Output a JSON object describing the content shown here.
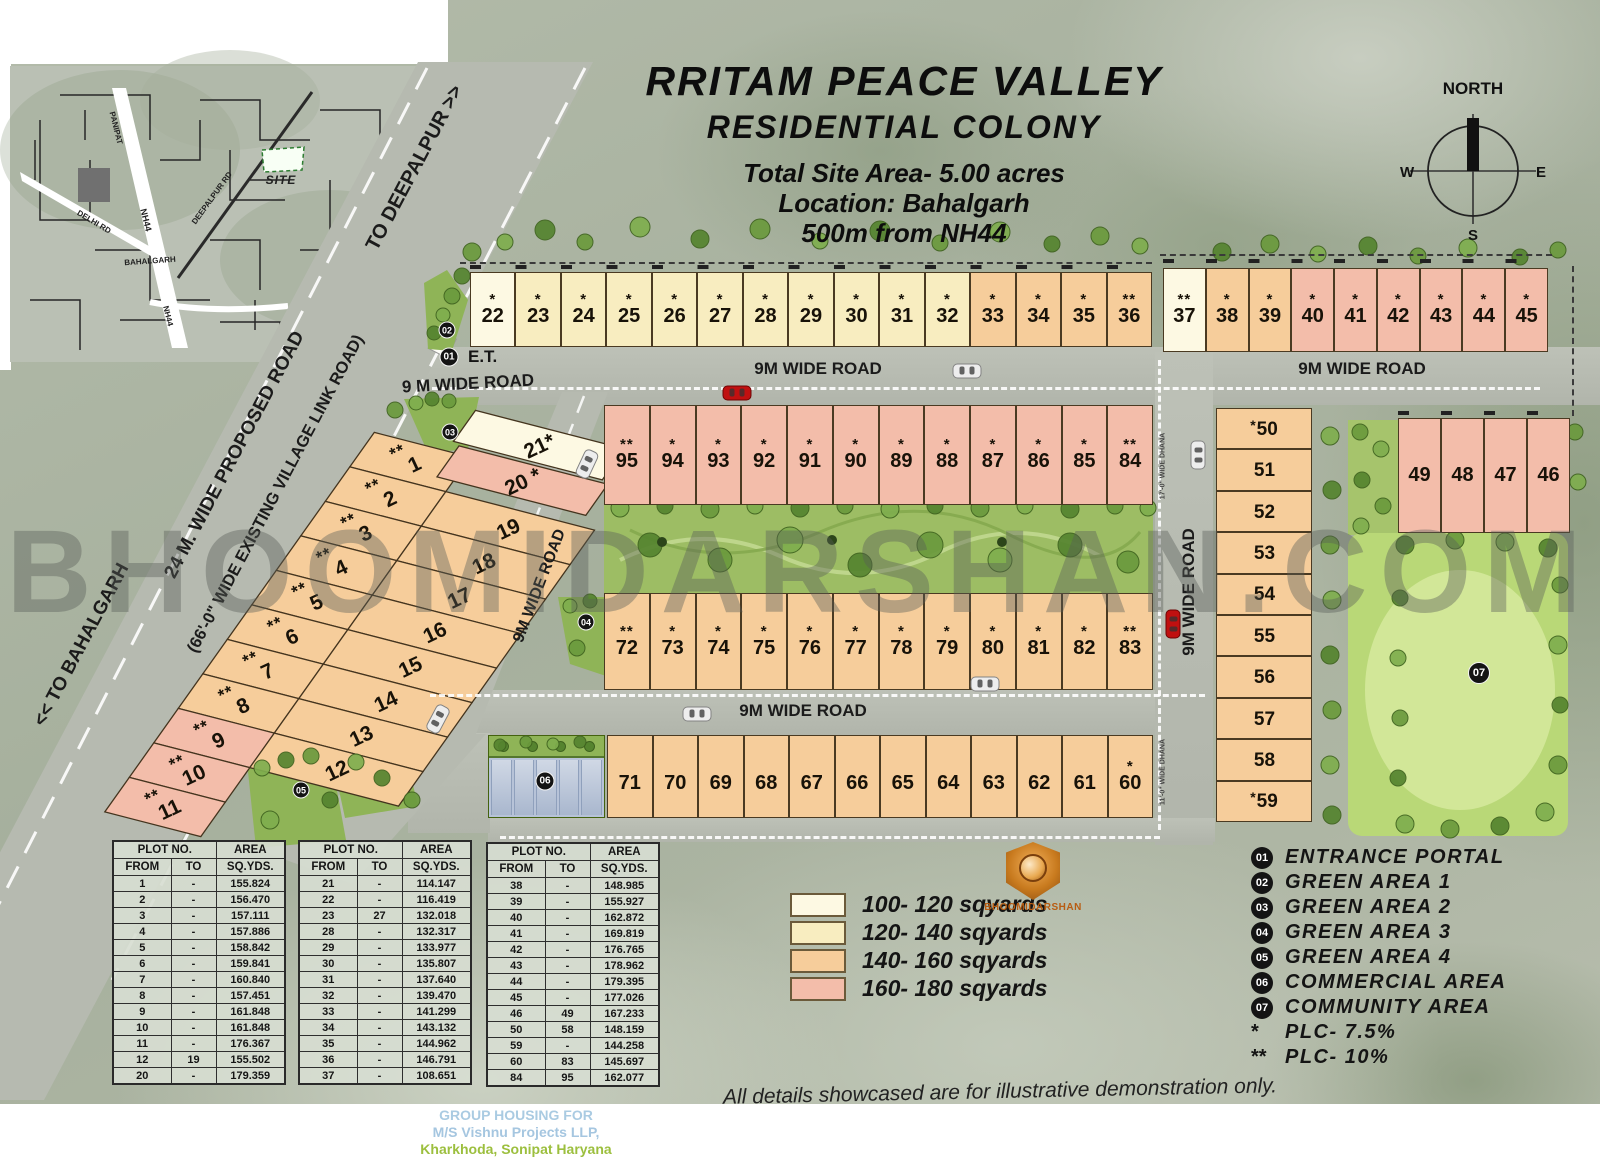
{
  "title": {
    "l1": "RRITAM PEACE VALLEY",
    "l2": "RESIDENTIAL COLONY",
    "l3": "Total Site Area- 5.00 acres",
    "l4": "Location: Bahalgarh",
    "l5": "500m from NH44"
  },
  "compass": {
    "north": "NORTH",
    "west": "W",
    "east": "E",
    "south": "S"
  },
  "inset": {
    "site": "SITE",
    "panipat": "PANIPAT",
    "nh44": "NH44",
    "delhi_rd": "DELHI RD",
    "bahalgarh": "BAHALGARH",
    "deepalpur_rd": "DEEPALPUR RD"
  },
  "road_labels": [
    "TO DEEPALPUR >>",
    "24 M. WIDE PROPOSED ROAD",
    "(66'-0\" WIDE EXISTING VILLAGE LINK ROAD)",
    "<< TO BAHALGARH",
    "9 M WIDE ROAD",
    "9M WIDE ROAD",
    "9M WIDE ROAD",
    "9M WIDE ROAD",
    "9M WIDE ROAD",
    "9M WIDE ROAD",
    "17'-0\" WIDE DHANA",
    "11'-0\" WIDE DHANA"
  ],
  "notes": {
    "et": "E.T.",
    "watermark": "BHOOMIDARSHAN.COM",
    "disclaimer": "All details showcased are for illustrative demonstration only.",
    "footer1": "GROUP HOUSING FOR",
    "footer2": "M/S Vishnu Projects LLP,",
    "footer3": "Kharkhoda, Sonipat Haryana"
  },
  "logo": {
    "name": "BHOOMIDARSHAN"
  },
  "markers": [
    "01",
    "02",
    "03",
    "04",
    "05",
    "06",
    "07"
  ],
  "colors": {
    "cream": "#FDF9E3",
    "yellow": "#F8EDC0",
    "orange": "#F6CD9B",
    "pink": "#F3BDAA"
  },
  "plots": {
    "north_a": [
      {
        "n": "22",
        "s": "*",
        "c": "cream"
      },
      {
        "n": "23",
        "s": "*",
        "c": "yellow"
      },
      {
        "n": "24",
        "s": "*",
        "c": "yellow"
      },
      {
        "n": "25",
        "s": "*",
        "c": "yellow"
      },
      {
        "n": "26",
        "s": "*",
        "c": "yellow"
      },
      {
        "n": "27",
        "s": "*",
        "c": "yellow"
      },
      {
        "n": "28",
        "s": "*",
        "c": "yellow"
      },
      {
        "n": "29",
        "s": "*",
        "c": "yellow"
      },
      {
        "n": "30",
        "s": "*",
        "c": "yellow"
      },
      {
        "n": "31",
        "s": "*",
        "c": "yellow"
      },
      {
        "n": "32",
        "s": "*",
        "c": "yellow"
      },
      {
        "n": "33",
        "s": "*",
        "c": "orange"
      },
      {
        "n": "34",
        "s": "*",
        "c": "orange"
      },
      {
        "n": "35",
        "s": "*",
        "c": "orange"
      },
      {
        "n": "36",
        "s": "**",
        "c": "orange"
      }
    ],
    "north_b": [
      {
        "n": "37",
        "s": "**",
        "c": "cream"
      },
      {
        "n": "38",
        "s": "*",
        "c": "orange"
      },
      {
        "n": "39",
        "s": "*",
        "c": "orange"
      },
      {
        "n": "40",
        "s": "*",
        "c": "pink"
      },
      {
        "n": "41",
        "s": "*",
        "c": "pink"
      },
      {
        "n": "42",
        "s": "*",
        "c": "pink"
      },
      {
        "n": "43",
        "s": "*",
        "c": "pink"
      },
      {
        "n": "44",
        "s": "*",
        "c": "pink"
      },
      {
        "n": "45",
        "s": "*",
        "c": "pink"
      }
    ],
    "mid_pink": [
      {
        "n": "95",
        "s": "**",
        "c": "pink"
      },
      {
        "n": "94",
        "s": "*",
        "c": "pink"
      },
      {
        "n": "93",
        "s": "*",
        "c": "pink"
      },
      {
        "n": "92",
        "s": "*",
        "c": "pink"
      },
      {
        "n": "91",
        "s": "*",
        "c": "pink"
      },
      {
        "n": "90",
        "s": "*",
        "c": "pink"
      },
      {
        "n": "89",
        "s": "*",
        "c": "pink"
      },
      {
        "n": "88",
        "s": "*",
        "c": "pink"
      },
      {
        "n": "87",
        "s": "*",
        "c": "pink"
      },
      {
        "n": "86",
        "s": "*",
        "c": "pink"
      },
      {
        "n": "85",
        "s": "*",
        "c": "pink"
      },
      {
        "n": "84",
        "s": "**",
        "c": "pink"
      }
    ],
    "mid_orange": [
      {
        "n": "72",
        "s": "**",
        "c": "orange"
      },
      {
        "n": "73",
        "s": "*",
        "c": "orange"
      },
      {
        "n": "74",
        "s": "*",
        "c": "orange"
      },
      {
        "n": "75",
        "s": "*",
        "c": "orange"
      },
      {
        "n": "76",
        "s": "*",
        "c": "orange"
      },
      {
        "n": "77",
        "s": "*",
        "c": "orange"
      },
      {
        "n": "78",
        "s": "*",
        "c": "orange"
      },
      {
        "n": "79",
        "s": "*",
        "c": "orange"
      },
      {
        "n": "80",
        "s": "*",
        "c": "orange"
      },
      {
        "n": "81",
        "s": "*",
        "c": "orange"
      },
      {
        "n": "82",
        "s": "*",
        "c": "orange"
      },
      {
        "n": "83",
        "s": "**",
        "c": "orange"
      }
    ],
    "south": [
      {
        "n": "71",
        "c": "orange"
      },
      {
        "n": "70",
        "c": "orange"
      },
      {
        "n": "69",
        "c": "orange"
      },
      {
        "n": "68",
        "c": "orange"
      },
      {
        "n": "67",
        "c": "orange"
      },
      {
        "n": "66",
        "c": "orange"
      },
      {
        "n": "65",
        "c": "orange"
      },
      {
        "n": "64",
        "c": "orange"
      },
      {
        "n": "63",
        "c": "orange"
      },
      {
        "n": "62",
        "c": "orange"
      },
      {
        "n": "61",
        "c": "orange"
      },
      {
        "n": "60",
        "s": "*",
        "c": "orange"
      }
    ],
    "east_col": [
      {
        "n": "50",
        "s": "*",
        "c": "orange"
      },
      {
        "n": "51",
        "c": "orange"
      },
      {
        "n": "52",
        "c": "orange"
      },
      {
        "n": "53",
        "c": "orange"
      },
      {
        "n": "54",
        "c": "orange"
      },
      {
        "n": "55",
        "c": "orange"
      },
      {
        "n": "56",
        "c": "orange"
      },
      {
        "n": "57",
        "c": "orange"
      },
      {
        "n": "58",
        "c": "orange"
      },
      {
        "n": "59",
        "s": "*",
        "c": "orange"
      }
    ],
    "ne_block": [
      {
        "n": "49",
        "c": "pink"
      },
      {
        "n": "48",
        "c": "pink"
      },
      {
        "n": "47",
        "c": "pink"
      },
      {
        "n": "46",
        "c": "pink"
      }
    ],
    "diag_left": [
      {
        "n": "1",
        "s": "**",
        "c": "orange"
      },
      {
        "n": "2",
        "s": "**",
        "c": "orange"
      },
      {
        "n": "3",
        "s": "**",
        "c": "orange"
      },
      {
        "n": "4",
        "s": "**",
        "c": "orange"
      },
      {
        "n": "5",
        "s": "**",
        "c": "orange"
      },
      {
        "n": "6",
        "s": "**",
        "c": "orange"
      },
      {
        "n": "7",
        "s": "**",
        "c": "orange"
      },
      {
        "n": "8",
        "s": "**",
        "c": "orange"
      },
      {
        "n": "9",
        "s": "**",
        "c": "pink"
      },
      {
        "n": "10",
        "s": "**",
        "c": "pink"
      },
      {
        "n": "11",
        "s": "**",
        "c": "pink"
      }
    ],
    "diag_right": [
      {
        "n": "21",
        "s": "*",
        "c": "cream",
        "j": -1
      },
      {
        "n": "20",
        "s": "*",
        "c": "pink",
        "j": 0
      },
      {
        "n": "19",
        "c": "orange",
        "j": 1
      },
      {
        "n": "18",
        "c": "orange",
        "j": 2
      },
      {
        "n": "17",
        "c": "orange",
        "j": 3
      },
      {
        "n": "16",
        "c": "orange",
        "j": 4
      },
      {
        "n": "15",
        "c": "orange",
        "j": 5
      },
      {
        "n": "14",
        "c": "orange",
        "j": 6
      },
      {
        "n": "13",
        "c": "orange",
        "j": 7
      },
      {
        "n": "12",
        "c": "orange",
        "j": 8
      }
    ]
  },
  "size_legend": [
    {
      "color": "#FDF9E3",
      "label": "100- 120 sqyards"
    },
    {
      "color": "#F8EDC0",
      "label": "120- 140 sqyards"
    },
    {
      "color": "#F6CD9B",
      "label": "140- 160 sqyards"
    },
    {
      "color": "#F3BDAA",
      "label": "160- 180 sqyards"
    }
  ],
  "area_legend": [
    {
      "num": "01",
      "label": "ENTRANCE PORTAL"
    },
    {
      "num": "02",
      "label": "GREEN AREA 1"
    },
    {
      "num": "03",
      "label": "GREEN AREA 2"
    },
    {
      "num": "04",
      "label": "GREEN AREA 3"
    },
    {
      "num": "05",
      "label": "GREEN AREA 4"
    },
    {
      "num": "06",
      "label": "COMMERCIAL AREA"
    },
    {
      "num": "07",
      "label": "COMMUNITY AREA"
    },
    {
      "num": "*",
      "label": "PLC- 7.5%",
      "sym": true
    },
    {
      "num": "**",
      "label": "PLC- 10%",
      "sym": true
    }
  ],
  "tables": {
    "headers": {
      "plot": "PLOT NO.",
      "area": "AREA",
      "from": "FROM",
      "to": "TO",
      "sqyds": "SQ.YDS."
    },
    "t1": [
      [
        "1",
        "-",
        "155.824"
      ],
      [
        "2",
        "-",
        "156.470"
      ],
      [
        "3",
        "-",
        "157.111"
      ],
      [
        "4",
        "-",
        "157.886"
      ],
      [
        "5",
        "-",
        "158.842"
      ],
      [
        "6",
        "-",
        "159.841"
      ],
      [
        "7",
        "-",
        "160.840"
      ],
      [
        "8",
        "-",
        "157.451"
      ],
      [
        "9",
        "-",
        "161.848"
      ],
      [
        "10",
        "-",
        "161.848"
      ],
      [
        "11",
        "-",
        "176.367"
      ],
      [
        "12",
        "19",
        "155.502"
      ],
      [
        "20",
        "-",
        "179.359"
      ]
    ],
    "t2": [
      [
        "21",
        "-",
        "114.147"
      ],
      [
        "22",
        "-",
        "116.419"
      ],
      [
        "23",
        "27",
        "132.018"
      ],
      [
        "28",
        "-",
        "132.317"
      ],
      [
        "29",
        "-",
        "133.977"
      ],
      [
        "30",
        "-",
        "135.807"
      ],
      [
        "31",
        "-",
        "137.640"
      ],
      [
        "32",
        "-",
        "139.470"
      ],
      [
        "33",
        "-",
        "141.299"
      ],
      [
        "34",
        "-",
        "143.132"
      ],
      [
        "35",
        "-",
        "144.962"
      ],
      [
        "36",
        "-",
        "146.791"
      ],
      [
        "37",
        "-",
        "108.651"
      ]
    ],
    "t3": [
      [
        "38",
        "-",
        "148.985"
      ],
      [
        "39",
        "-",
        "155.927"
      ],
      [
        "40",
        "-",
        "162.872"
      ],
      [
        "41",
        "-",
        "169.819"
      ],
      [
        "42",
        "-",
        "176.765"
      ],
      [
        "43",
        "-",
        "178.962"
      ],
      [
        "44",
        "-",
        "179.395"
      ],
      [
        "45",
        "-",
        "177.026"
      ],
      [
        "46",
        "49",
        "167.233"
      ],
      [
        "50",
        "58",
        "148.159"
      ],
      [
        "59",
        "-",
        "144.258"
      ],
      [
        "60",
        "83",
        "145.697"
      ],
      [
        "84",
        "95",
        "162.077"
      ]
    ]
  }
}
